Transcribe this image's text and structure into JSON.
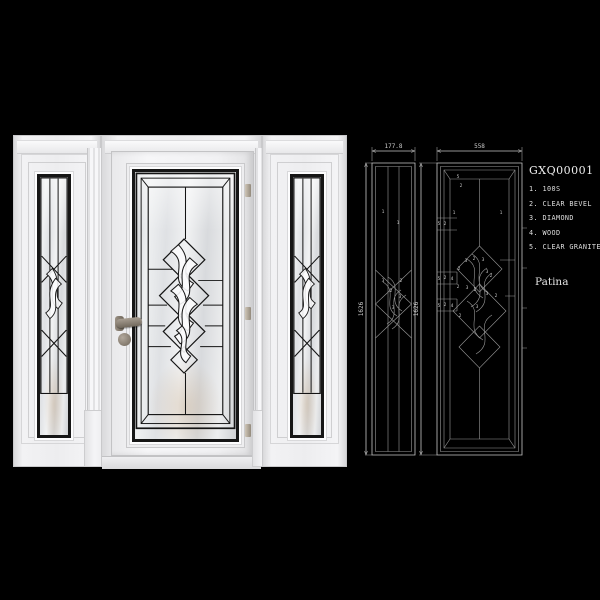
{
  "product": {
    "code": "GXQ00001",
    "finish_label": "Patina",
    "materials": [
      "1. 100S",
      "2. CLEAR BEVEL",
      "3. DIAMOND",
      "4. WOOD",
      "5. CLEAR GRANITE"
    ]
  },
  "drawings": {
    "sidelight": {
      "width_label": "177.8",
      "height_label": "1626",
      "labels": [
        {
          "x": 28,
          "y": 75,
          "t": "1"
        },
        {
          "x": 43,
          "y": 86,
          "t": "1"
        },
        {
          "x": 28,
          "y": 144,
          "t": "3"
        },
        {
          "x": 46,
          "y": 144,
          "t": "2"
        },
        {
          "x": 36,
          "y": 154,
          "t": "2"
        },
        {
          "x": 45,
          "y": 160,
          "t": "3"
        },
        {
          "x": 38,
          "y": 171,
          "t": "3"
        }
      ]
    },
    "door": {
      "width_label": "558",
      "height_label": "1626",
      "labels": [
        {
          "x": 103,
          "y": 40,
          "t": "5"
        },
        {
          "x": 106,
          "y": 49,
          "t": "2"
        },
        {
          "x": 99,
          "y": 76,
          "t": "1"
        },
        {
          "x": 146,
          "y": 76,
          "t": "1"
        },
        {
          "x": 84,
          "y": 87,
          "t": "5"
        },
        {
          "x": 90,
          "y": 87,
          "t": "2"
        },
        {
          "x": 111,
          "y": 124,
          "t": "3"
        },
        {
          "x": 119,
          "y": 122,
          "t": "2"
        },
        {
          "x": 128,
          "y": 123,
          "t": "3"
        },
        {
          "x": 104,
          "y": 132,
          "t": "2"
        },
        {
          "x": 132,
          "y": 135,
          "t": "3"
        },
        {
          "x": 136,
          "y": 139,
          "t": "2"
        },
        {
          "x": 84,
          "y": 142,
          "t": "5"
        },
        {
          "x": 90,
          "y": 141,
          "t": "2"
        },
        {
          "x": 97,
          "y": 142,
          "t": "4"
        },
        {
          "x": 103,
          "y": 150,
          "t": "2"
        },
        {
          "x": 112,
          "y": 151,
          "t": "3"
        },
        {
          "x": 120,
          "y": 153,
          "t": "2"
        },
        {
          "x": 132,
          "y": 157,
          "t": "3"
        },
        {
          "x": 141,
          "y": 159,
          "t": "2"
        },
        {
          "x": 84,
          "y": 169,
          "t": "5"
        },
        {
          "x": 90,
          "y": 168,
          "t": "2"
        },
        {
          "x": 97,
          "y": 169,
          "t": "4"
        },
        {
          "x": 122,
          "y": 170,
          "t": "3"
        },
        {
          "x": 105,
          "y": 179,
          "t": "2"
        }
      ]
    }
  },
  "colors": {
    "background": "#000000",
    "drawing_line": "#c6c6c6",
    "came_lead": "#161616",
    "door_white": "#f2f2f4"
  }
}
